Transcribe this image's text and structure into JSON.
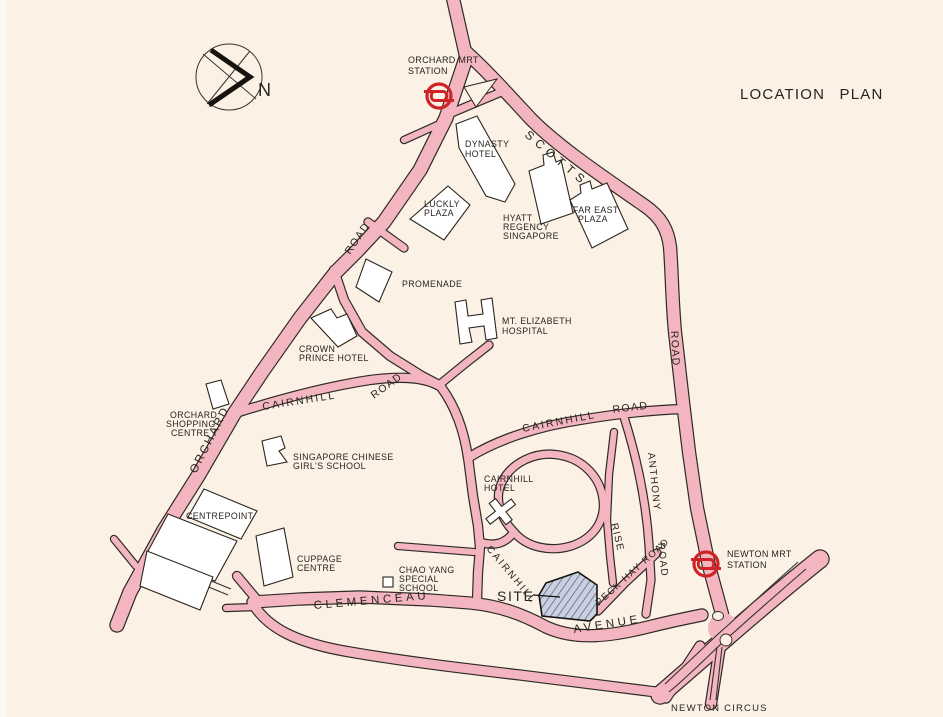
{
  "title": "LOCATION PLAN",
  "compass": {
    "north_label": "N"
  },
  "colors": {
    "background": "#fbf1e4",
    "road_fill": "#f3b6c1",
    "road_casing": "#2e2a26",
    "building_fill": "#ffffff",
    "mrt_red": "#cd2428",
    "site_fill": "#cad0df",
    "site_hatch": "#5d6884",
    "text": "#29241f"
  },
  "stations": {
    "orchard": {
      "line1": "ORCHARD MRT",
      "line2": "STATION"
    },
    "newton": {
      "line1": "NEWTON MRT",
      "line2": "STATION"
    }
  },
  "roads": {
    "scotts": {
      "name": "SCOTTS",
      "suffix": "ROAD"
    },
    "orchard": {
      "name": "ORCHARD",
      "suffix": "ROAD"
    },
    "cairnhill_west": {
      "name": "CAIRNHILL",
      "suffix": "ROAD"
    },
    "cairnhill_east": {
      "name": "CAIRNHILL",
      "suffix": "ROAD"
    },
    "cairnhill_south": {
      "name": "CAIRNHILL"
    },
    "cairnhill_rise": {
      "name": "RISE"
    },
    "anthony": {
      "name": "ANTHONY",
      "suffix": "ROAD"
    },
    "peck_hay": {
      "name": "PECK HAY ROAD"
    },
    "clemenceau": {
      "name": "CLEMENCEAU",
      "suffix": "AVENUE"
    },
    "newton_circus": {
      "name": "NEWTON CIRCUS"
    }
  },
  "site": {
    "label": "SITE"
  },
  "buildings": {
    "dynasty_hotel": {
      "line1": "DYNASTY",
      "line2": "HOTEL"
    },
    "luckly_plaza": {
      "line1": "LUCKLY",
      "line2": "PLAZA"
    },
    "hyatt_regency": {
      "line1": "HYATT",
      "line2": "REGENCY",
      "line3": "SINGAPORE"
    },
    "far_east_plaza": {
      "line1": "FAR EAST",
      "line2": "PLAZA"
    },
    "promenade": {
      "line1": "PROMENADE"
    },
    "mt_elizabeth_hospital": {
      "line1": "MT. ELIZABETH",
      "line2": "HOSPITAL"
    },
    "crown_prince_hotel": {
      "line1": "CROWN",
      "line2": "PRINCE HOTEL"
    },
    "orchard_shopping_centre": {
      "line1": "ORCHARD",
      "line2": "SHOPPING",
      "line3": "CENTRE"
    },
    "singapore_chinese_girls_school": {
      "line1": "SINGAPORE CHINESE",
      "line2": "GIRL'S SCHOOL"
    },
    "centrepoint": {
      "line1": "CENTREPOINT"
    },
    "cuppage_centre": {
      "line1": "CUPPAGE",
      "line2": "CENTRE"
    },
    "chao_yang_special_school": {
      "line1": "CHAO YANG",
      "line2": "SPECIAL",
      "line3": "SCHOOL"
    },
    "cairnhill_hotel": {
      "line1": "CAIRNHILL",
      "line2": "HOTEL"
    }
  }
}
